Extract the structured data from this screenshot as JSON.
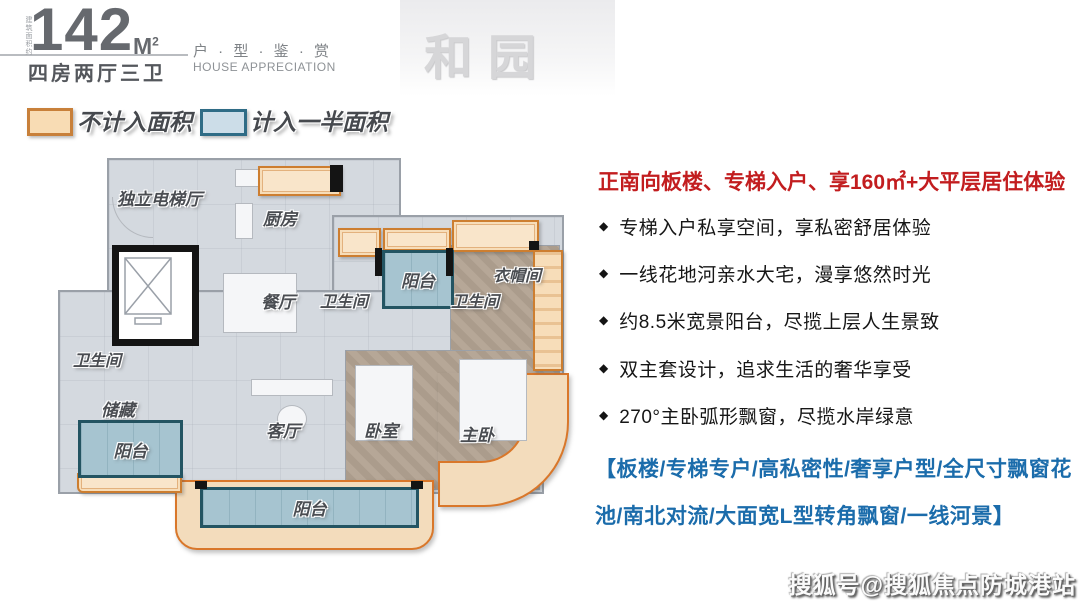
{
  "header": {
    "area_vertical_label": "建筑面积约",
    "area_number": "142",
    "area_unit": "M",
    "area_unit_sup": "2",
    "room_config": "四房两厅三卫",
    "series_title": "户 · 型 · 鉴 · 赏",
    "series_subtitle": "HOUSE APPRECIATION",
    "watermark": "和园"
  },
  "legend": {
    "not_counted_label": "不计入面积",
    "half_counted_label": "计入一半面积",
    "not_counted_fill": "#f8dcb4",
    "not_counted_border": "#c8803a",
    "half_counted_fill": "#ccdde8",
    "half_counted_border": "#2f6c86"
  },
  "floorplan": {
    "rooms": [
      {
        "name": "elevator-hall",
        "label": "独立电梯厅"
      },
      {
        "name": "kitchen",
        "label": "厨房"
      },
      {
        "name": "dining-room",
        "label": "餐厅"
      },
      {
        "name": "bathroom-center",
        "label": "卫生间"
      },
      {
        "name": "balcony-top",
        "label": "阳台"
      },
      {
        "name": "bathroom-right",
        "label": "卫生间"
      },
      {
        "name": "cloakroom",
        "label": "衣帽间"
      },
      {
        "name": "bathroom-left",
        "label": "卫生间"
      },
      {
        "name": "storage",
        "label": "储藏"
      },
      {
        "name": "balcony-left",
        "label": "阳台"
      },
      {
        "name": "living-room",
        "label": "客厅"
      },
      {
        "name": "bedroom",
        "label": "卧室"
      },
      {
        "name": "master-bedroom",
        "label": "主卧"
      },
      {
        "name": "balcony-bottom",
        "label": "阳台"
      }
    ]
  },
  "highlights": {
    "headline": "正南向板楼、专梯入户、享160㎡+大平层居住体验",
    "marker": "◆",
    "bullets": [
      "专梯入户私享空间，享私密舒居体验",
      "一线花地河亲水大宅，漫享悠然时光",
      "约8.5米宽景阳台，尽揽上层人生景致",
      "双主套设计，追求生活的奢华享受",
      "270°主卧弧形飘窗，尽揽水岸绿意"
    ],
    "tags_line1": "【板楼/专梯专户/高私密性/奢享户型/全尺寸飘窗花",
    "tags_line2": "池/南北对流/大面宽L型转角飘窗/一线河景】"
  },
  "footer": {
    "watermark": "搜狐号@搜狐焦点防城港站"
  },
  "colors": {
    "headline_red": "#c21d1f",
    "tags_blue": "#1b6cab",
    "bay_orange_border": "#cd7e30",
    "bay_orange_fill": "#f7ddb9",
    "balcony_blue_fill": "#a6c4d0",
    "balcony_blue_border": "#235462"
  }
}
